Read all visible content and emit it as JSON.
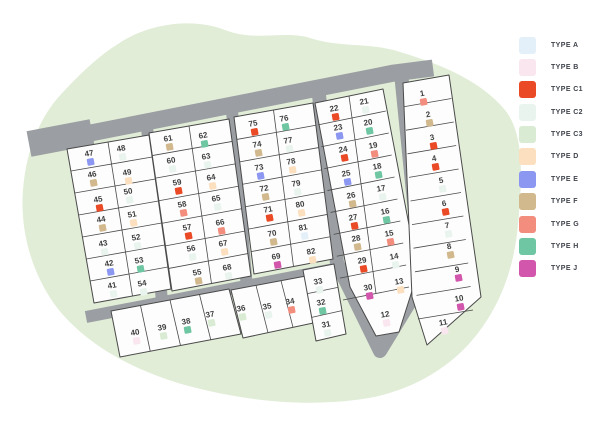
{
  "scene": {
    "width": 600,
    "height": 424,
    "background": "#ffffff"
  },
  "legend": {
    "items": [
      {
        "type": "A",
        "label": "TYPE A",
        "color": "#e4f0f9"
      },
      {
        "type": "B",
        "label": "TYPE B",
        "color": "#f9e6ef"
      },
      {
        "type": "C1",
        "label": "TYPE C1",
        "color": "#ea4a26"
      },
      {
        "type": "C2",
        "label": "TYPE C2",
        "color": "#eaf4ee"
      },
      {
        "type": "C3",
        "label": "TYPE C3",
        "color": "#d9ebd3"
      },
      {
        "type": "D",
        "label": "TYPE D",
        "color": "#fbdfbf"
      },
      {
        "type": "E",
        "label": "TYPE E",
        "color": "#8b97f1"
      },
      {
        "type": "F",
        "label": "TYPE F",
        "color": "#d2b88d"
      },
      {
        "type": "G",
        "label": "TYPE G",
        "color": "#f38d7e"
      },
      {
        "type": "H",
        "label": "TYPE H",
        "color": "#6fc6a2"
      },
      {
        "type": "J",
        "label": "TYPE J",
        "color": "#d156ac"
      }
    ]
  },
  "site_plan": {
    "landscape_color": "#e1edd7",
    "road_color": "#9b9ea2",
    "parcel_fill": "#fdfdfd",
    "parcel_stroke": "#4a4a4a",
    "label_color": "#3e3e3e",
    "rotation_deg": -10.5,
    "blob_path": "M 118 44 C 150 22 195 18 225 30 C 255 42 285 30 310 38 C 340 48 370 42 400 52 C 440 64 480 80 505 110 C 525 135 522 180 518 225 C 514 268 500 310 468 345 C 440 375 400 395 355 400 C 300 407 240 400 185 385 C 135 371 85 345 55 305 C 30 270 18 225 24 180 C 28 148 40 115 65 90 C 82 72 100 55 118 44 Z",
    "roads": [
      {
        "name": "road-entry-stub",
        "points": [
          [
            29,
            144
          ],
          [
            92,
            132
          ]
        ],
        "width": 26
      },
      {
        "name": "road-main",
        "points": [
          [
            30,
            145
          ],
          [
            394,
            73
          ],
          [
            433,
            68
          ]
        ],
        "width": 17
      },
      {
        "name": "road-between-1-2",
        "points": [
          [
            147,
            127
          ],
          [
            162,
            302
          ]
        ],
        "width": 12
      },
      {
        "name": "road-between-2-3",
        "points": [
          [
            232,
            111
          ],
          [
            247,
            289
          ]
        ],
        "width": 12
      },
      {
        "name": "road-loop",
        "points": [
          [
            319,
            95
          ],
          [
            337,
            263
          ],
          [
            380,
            351
          ],
          [
            422,
            282
          ],
          [
            401,
            73
          ]
        ],
        "width": 14
      },
      {
        "name": "road-bottom",
        "points": [
          [
            86,
            317
          ],
          [
            334,
            269
          ]
        ],
        "width": 12
      }
    ],
    "blocks": [
      {
        "name": "block-41-54",
        "corners": [
          [
            67,
            149
          ],
          [
            149,
            135
          ],
          [
            171,
            289
          ],
          [
            94,
            303
          ]
        ],
        "rows": 7,
        "cols": 2
      },
      {
        "name": "block-55-68",
        "corners": [
          [
            149,
            133
          ],
          [
            229,
            119
          ],
          [
            251,
            276
          ],
          [
            172,
            291
          ]
        ],
        "rows": 7,
        "cols": 2
      },
      {
        "name": "block-69-82",
        "corners": [
          [
            234,
            117
          ],
          [
            313,
            103
          ],
          [
            333,
            259
          ],
          [
            254,
            274
          ]
        ],
        "rows": 7,
        "cols": 2
      },
      {
        "name": "block-12-30",
        "polygon": [
          [
            315,
            103
          ],
          [
            383,
            89
          ],
          [
            418,
            272
          ],
          [
            399,
            332
          ],
          [
            376,
            336
          ],
          [
            350,
            287
          ]
        ],
        "corners": [
          [
            315,
            103
          ],
          [
            383,
            89
          ],
          [
            409,
            287
          ],
          [
            343,
            300
          ]
        ],
        "rows": 9,
        "cols": 2,
        "extra_lines": [
          [
            [
              343,
              300
            ],
            [
              409,
              287
            ]
          ]
        ]
      },
      {
        "name": "block-1-11",
        "polygon": [
          [
            403,
            83
          ],
          [
            449,
            75
          ],
          [
            481,
            297
          ],
          [
            427,
            345
          ],
          [
            412,
            297
          ]
        ],
        "corners": [
          [
            403,
            83
          ],
          [
            449,
            75
          ],
          [
            473,
            310
          ],
          [
            418,
            319
          ]
        ],
        "rows": 10,
        "cols": 1,
        "extra_lines": [
          [
            [
              418,
              319
            ],
            [
              473,
              310
            ]
          ]
        ]
      },
      {
        "name": "strip-37-40",
        "corners": [
          [
            111,
            311
          ],
          [
            229,
            289
          ],
          [
            241,
            334
          ],
          [
            120,
            357
          ]
        ],
        "rows": 1,
        "cols": 4
      },
      {
        "name": "strip-34-36",
        "corners": [
          [
            231,
            290
          ],
          [
            306,
            276
          ],
          [
            318,
            322
          ],
          [
            243,
            338
          ]
        ],
        "rows": 1,
        "cols": 3
      },
      {
        "name": "strip-31-33",
        "corners": [
          [
            303,
            270
          ],
          [
            334,
            264
          ],
          [
            346,
            334
          ],
          [
            316,
            341
          ]
        ],
        "rows": 3,
        "cols": 1
      }
    ],
    "lots": [
      {
        "n": 1,
        "type": "G",
        "x": 422,
        "y": 93
      },
      {
        "n": 2,
        "type": "F",
        "x": 428,
        "y": 114
      },
      {
        "n": 3,
        "type": "C1",
        "x": 432,
        "y": 137
      },
      {
        "n": 4,
        "type": "C1",
        "x": 434,
        "y": 158
      },
      {
        "n": 5,
        "type": "C2",
        "x": 441,
        "y": 180
      },
      {
        "n": 6,
        "type": "C1",
        "x": 444,
        "y": 203
      },
      {
        "n": 7,
        "type": "C2",
        "x": 447,
        "y": 225
      },
      {
        "n": 8,
        "type": "F",
        "x": 449,
        "y": 246
      },
      {
        "n": 9,
        "type": "J",
        "x": 457,
        "y": 269
      },
      {
        "n": 10,
        "type": "J",
        "x": 459,
        "y": 298
      },
      {
        "n": 11,
        "type": "B",
        "x": 443,
        "y": 322
      },
      {
        "n": 12,
        "type": "B",
        "x": 385,
        "y": 314
      },
      {
        "n": 13,
        "type": "D",
        "x": 399,
        "y": 281
      },
      {
        "n": 14,
        "type": "C2",
        "x": 394,
        "y": 256
      },
      {
        "n": 15,
        "type": "G",
        "x": 389,
        "y": 233
      },
      {
        "n": 16,
        "type": "H",
        "x": 385,
        "y": 211
      },
      {
        "n": 17,
        "type": "C2",
        "x": 381,
        "y": 188
      },
      {
        "n": 18,
        "type": "H",
        "x": 377,
        "y": 166
      },
      {
        "n": 19,
        "type": "G",
        "x": 373,
        "y": 145
      },
      {
        "n": 20,
        "type": "H",
        "x": 368,
        "y": 122
      },
      {
        "n": 21,
        "type": "C2",
        "x": 364,
        "y": 101
      },
      {
        "n": 22,
        "type": "C1",
        "x": 334,
        "y": 108
      },
      {
        "n": 23,
        "type": "E",
        "x": 338,
        "y": 127
      },
      {
        "n": 24,
        "type": "C1",
        "x": 343,
        "y": 149
      },
      {
        "n": 25,
        "type": "E",
        "x": 346,
        "y": 173
      },
      {
        "n": 26,
        "type": "F",
        "x": 351,
        "y": 195
      },
      {
        "n": 27,
        "type": "C1",
        "x": 353,
        "y": 217
      },
      {
        "n": 28,
        "type": "F",
        "x": 356,
        "y": 238
      },
      {
        "n": 29,
        "type": "C1",
        "x": 362,
        "y": 260
      },
      {
        "n": 30,
        "type": "J",
        "x": 368,
        "y": 287
      },
      {
        "n": 31,
        "type": "C2",
        "x": 326,
        "y": 324
      },
      {
        "n": 32,
        "type": "H",
        "x": 321,
        "y": 302
      },
      {
        "n": 33,
        "type": "C2",
        "x": 318,
        "y": 281
      },
      {
        "n": 34,
        "type": "G",
        "x": 290,
        "y": 301
      },
      {
        "n": 35,
        "type": "C2",
        "x": 267,
        "y": 306
      },
      {
        "n": 36,
        "type": "C3",
        "x": 241,
        "y": 308
      },
      {
        "n": 37,
        "type": "C3",
        "x": 210,
        "y": 314
      },
      {
        "n": 38,
        "type": "H",
        "x": 186,
        "y": 321
      },
      {
        "n": 39,
        "type": "C3",
        "x": 162,
        "y": 327
      },
      {
        "n": 40,
        "type": "B",
        "x": 135,
        "y": 332
      },
      {
        "n": 41,
        "type": "C2",
        "x": 112,
        "y": 285
      },
      {
        "n": 42,
        "type": "E",
        "x": 109,
        "y": 263
      },
      {
        "n": 43,
        "type": "C2",
        "x": 103,
        "y": 243
      },
      {
        "n": 44,
        "type": "F",
        "x": 101,
        "y": 219
      },
      {
        "n": 45,
        "type": "C1",
        "x": 98,
        "y": 199
      },
      {
        "n": 46,
        "type": "F",
        "x": 92,
        "y": 174
      },
      {
        "n": 47,
        "type": "E",
        "x": 89,
        "y": 153
      },
      {
        "n": 48,
        "type": "C2",
        "x": 121,
        "y": 148
      },
      {
        "n": 49,
        "type": "D",
        "x": 127,
        "y": 172
      },
      {
        "n": 50,
        "type": "C2",
        "x": 128,
        "y": 191
      },
      {
        "n": 51,
        "type": "D",
        "x": 132,
        "y": 214
      },
      {
        "n": 52,
        "type": "C2",
        "x": 136,
        "y": 237
      },
      {
        "n": 53,
        "type": "H",
        "x": 139,
        "y": 260
      },
      {
        "n": 54,
        "type": "C2",
        "x": 142,
        "y": 283
      },
      {
        "n": 55,
        "type": "F",
        "x": 197,
        "y": 272
      },
      {
        "n": 56,
        "type": "C2",
        "x": 191,
        "y": 248
      },
      {
        "n": 57,
        "type": "C1",
        "x": 187,
        "y": 227
      },
      {
        "n": 58,
        "type": "G",
        "x": 182,
        "y": 204
      },
      {
        "n": 59,
        "type": "C1",
        "x": 177,
        "y": 182
      },
      {
        "n": 60,
        "type": "C2",
        "x": 171,
        "y": 160
      },
      {
        "n": 61,
        "type": "F",
        "x": 168,
        "y": 138
      },
      {
        "n": 62,
        "type": "H",
        "x": 203,
        "y": 135
      },
      {
        "n": 63,
        "type": "C2",
        "x": 206,
        "y": 156
      },
      {
        "n": 64,
        "type": "D",
        "x": 211,
        "y": 177
      },
      {
        "n": 65,
        "type": "C2",
        "x": 216,
        "y": 198
      },
      {
        "n": 66,
        "type": "G",
        "x": 220,
        "y": 222
      },
      {
        "n": 67,
        "type": "D",
        "x": 223,
        "y": 243
      },
      {
        "n": 68,
        "type": "C2",
        "x": 227,
        "y": 267
      },
      {
        "n": 69,
        "type": "J",
        "x": 276,
        "y": 256
      },
      {
        "n": 70,
        "type": "F",
        "x": 272,
        "y": 233
      },
      {
        "n": 71,
        "type": "C1",
        "x": 268,
        "y": 209
      },
      {
        "n": 72,
        "type": "F",
        "x": 264,
        "y": 188
      },
      {
        "n": 73,
        "type": "E",
        "x": 259,
        "y": 167
      },
      {
        "n": 74,
        "type": "F",
        "x": 257,
        "y": 144
      },
      {
        "n": 75,
        "type": "C1",
        "x": 253,
        "y": 123
      },
      {
        "n": 76,
        "type": "H",
        "x": 284,
        "y": 118
      },
      {
        "n": 77,
        "type": "C2",
        "x": 288,
        "y": 140
      },
      {
        "n": 78,
        "type": "D",
        "x": 291,
        "y": 161
      },
      {
        "n": 79,
        "type": "C2",
        "x": 296,
        "y": 183
      },
      {
        "n": 80,
        "type": "D",
        "x": 300,
        "y": 204
      },
      {
        "n": 81,
        "type": "A",
        "x": 303,
        "y": 227
      },
      {
        "n": 82,
        "type": "D",
        "x": 311,
        "y": 251
      }
    ]
  }
}
